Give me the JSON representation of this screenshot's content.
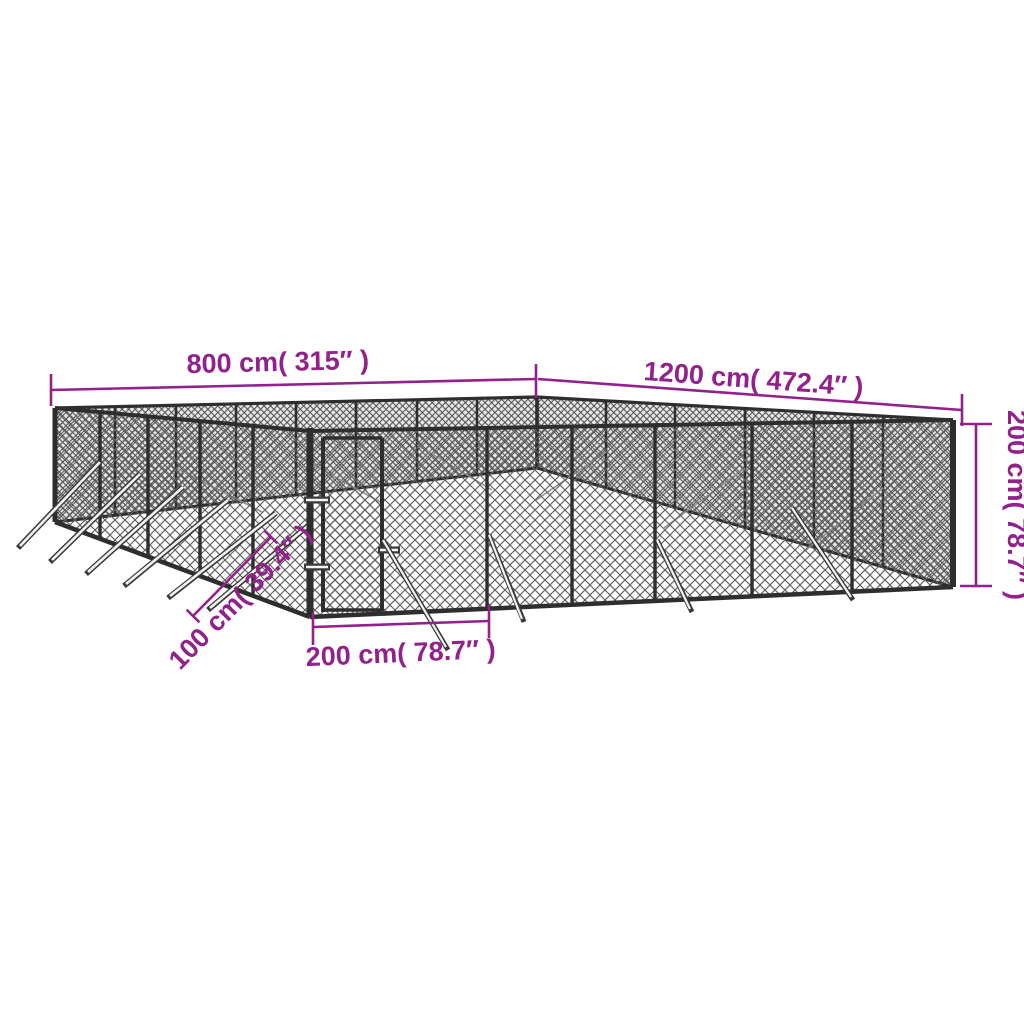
{
  "diagram": {
    "type": "product-dimension-diagram",
    "subject": "outdoor chain-link dog kennel with gate, perspective view",
    "dimensions": {
      "back_left_width": {
        "label": "800 cm( 315″ )"
      },
      "back_right_length": {
        "label": "1200 cm( 472.4″ )"
      },
      "height": {
        "label": "200 cm( 78.7″ )"
      },
      "stake_offset": {
        "label": "100 cm( 39.4″ )"
      },
      "gate_width": {
        "label": "200 cm( 78.7″ )"
      }
    },
    "colors": {
      "accent": "#93218C",
      "frame": "#2e2e2e",
      "mesh_front": "#5f5f5f",
      "mesh_back": "#4d4d4d",
      "background": "#ffffff"
    }
  }
}
